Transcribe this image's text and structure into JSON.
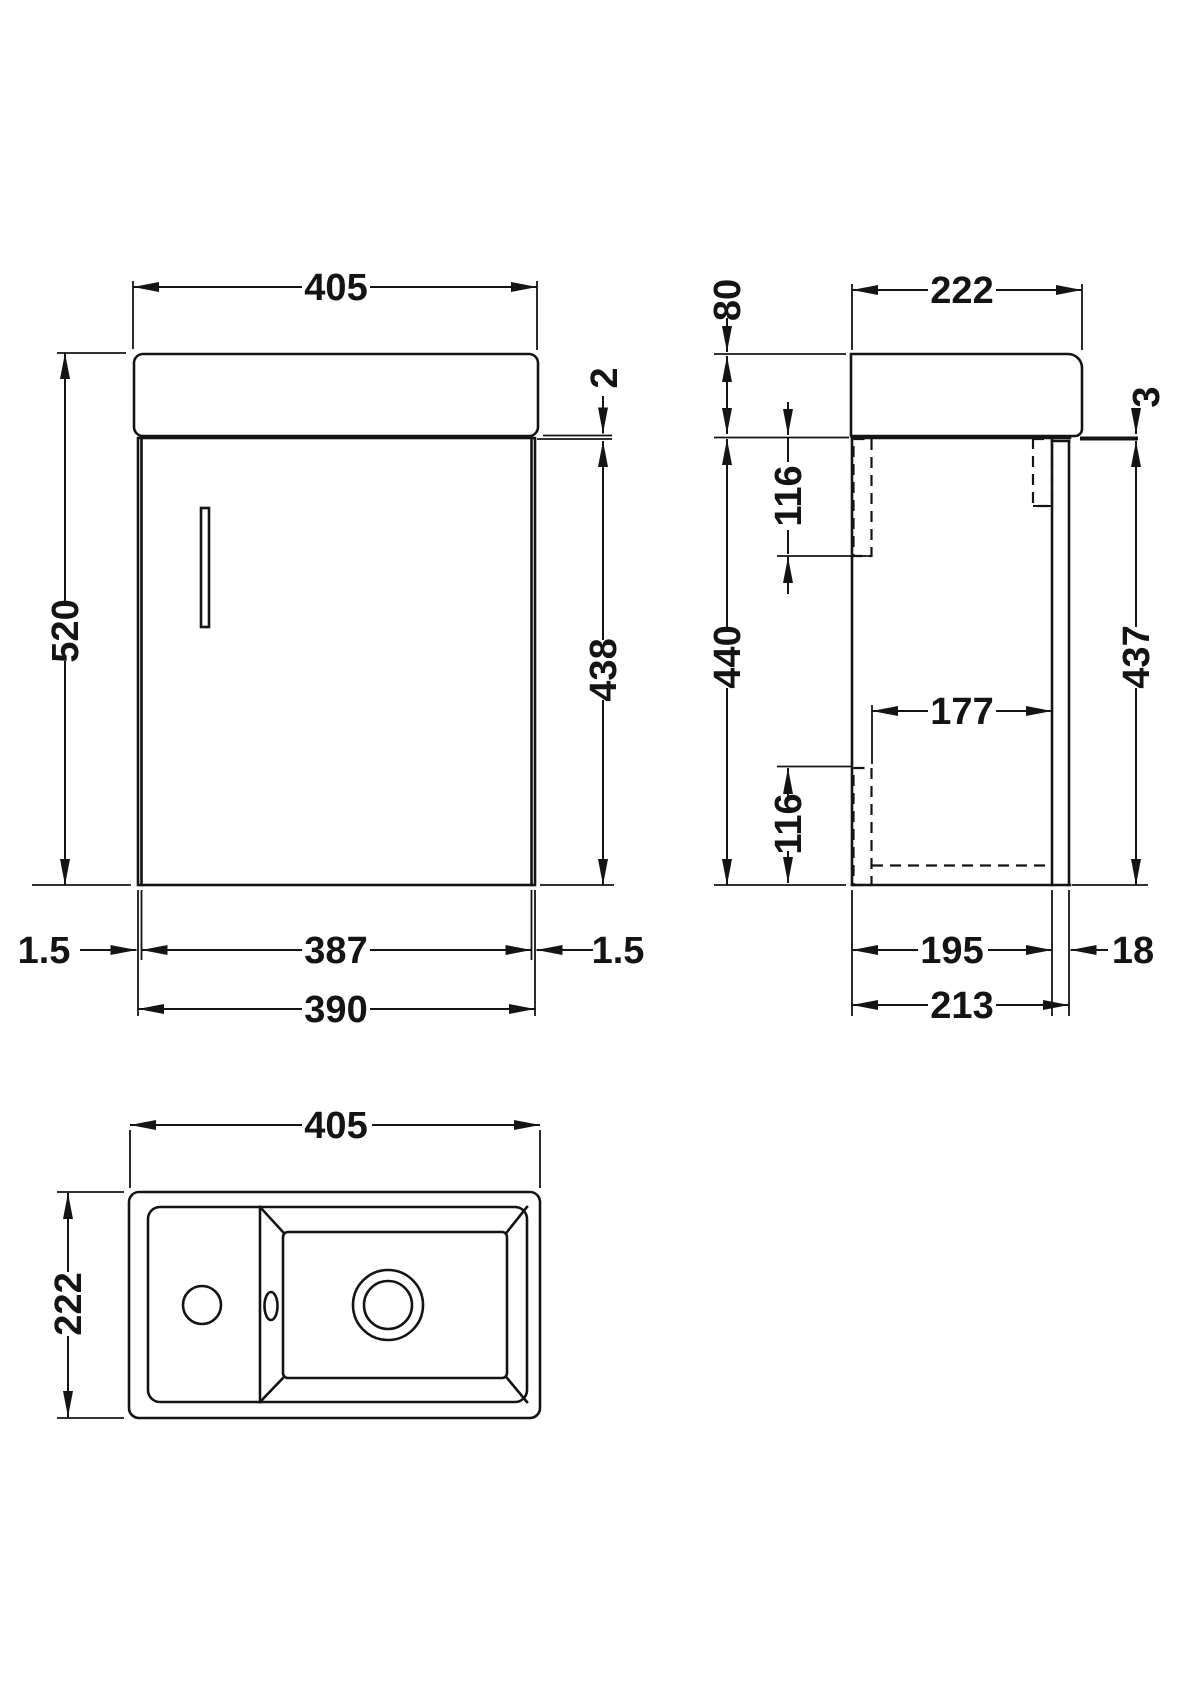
{
  "drawing": {
    "title": "Wall-hung cloakroom vanity unit with basin - dimensioned views",
    "units": "mm",
    "front": {
      "overall_width": "405",
      "overall_height": "520",
      "worktop_lip": "2",
      "cabinet_height": "438",
      "door_gap_left": "1.5",
      "door_width": "387",
      "door_gap_right": "1.5",
      "cabinet_width": "390"
    },
    "side": {
      "overall_depth": "222",
      "basin_height": "80",
      "door_top_gap": "3",
      "top_bracket_height": "116",
      "cabinet_height": "440",
      "door_height": "437",
      "internal_depth": "177",
      "bottom_bracket_height": "116",
      "carcass_depth": "195",
      "door_thickness": "18",
      "overall_cabinet_depth": "213"
    },
    "plan": {
      "overall_width": "405",
      "overall_depth": "222"
    }
  }
}
